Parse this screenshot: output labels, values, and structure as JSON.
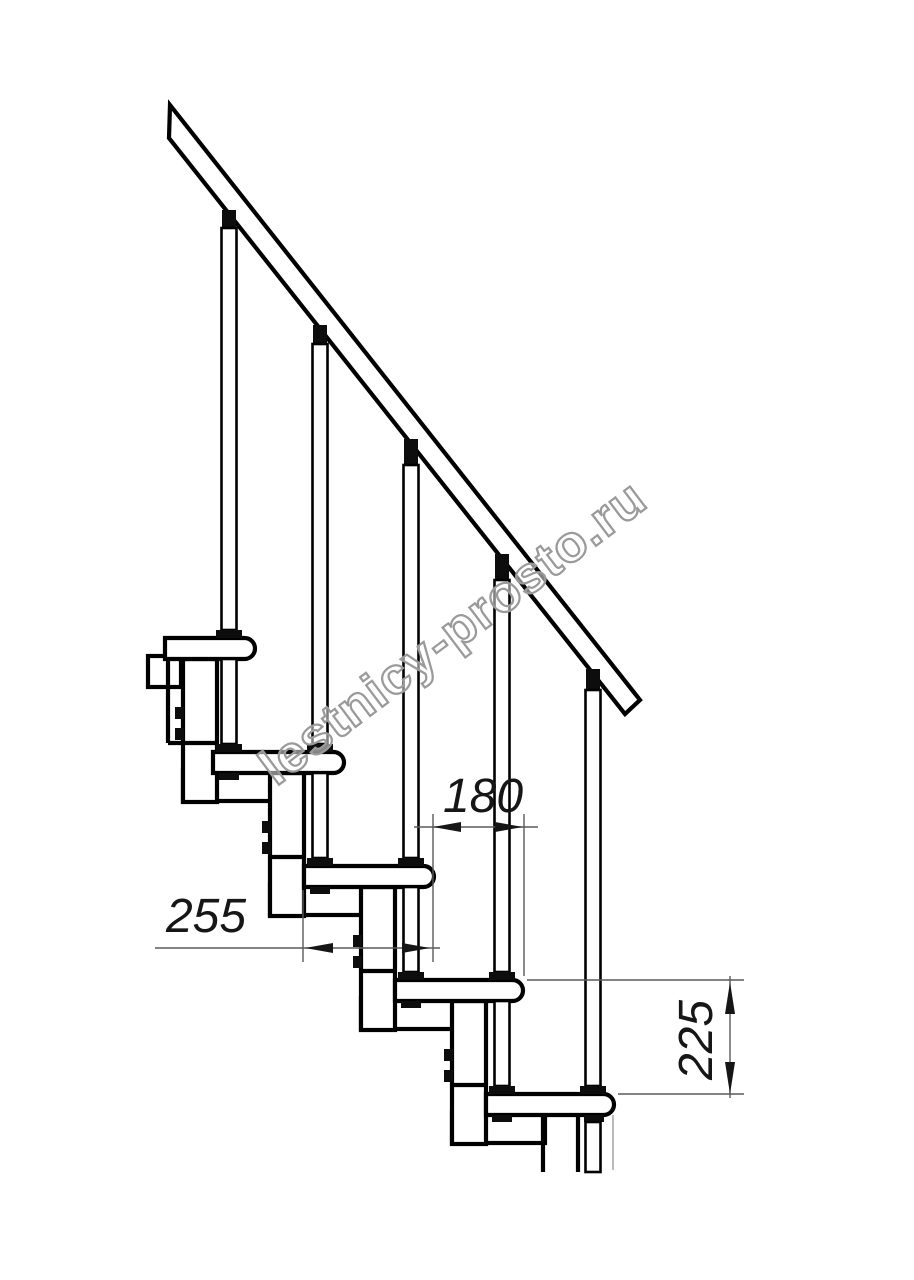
{
  "watermark": {
    "text": "lestnicy-prosto.ru"
  },
  "dimensions": {
    "step_run": {
      "value": "180"
    },
    "tread_depth": {
      "value": "255"
    },
    "step_rise": {
      "value": "225"
    }
  },
  "colors": {
    "line": "#000000",
    "dimension": "#5a5a5a",
    "watermark": "#9a9a9a",
    "background": "#ffffff"
  }
}
